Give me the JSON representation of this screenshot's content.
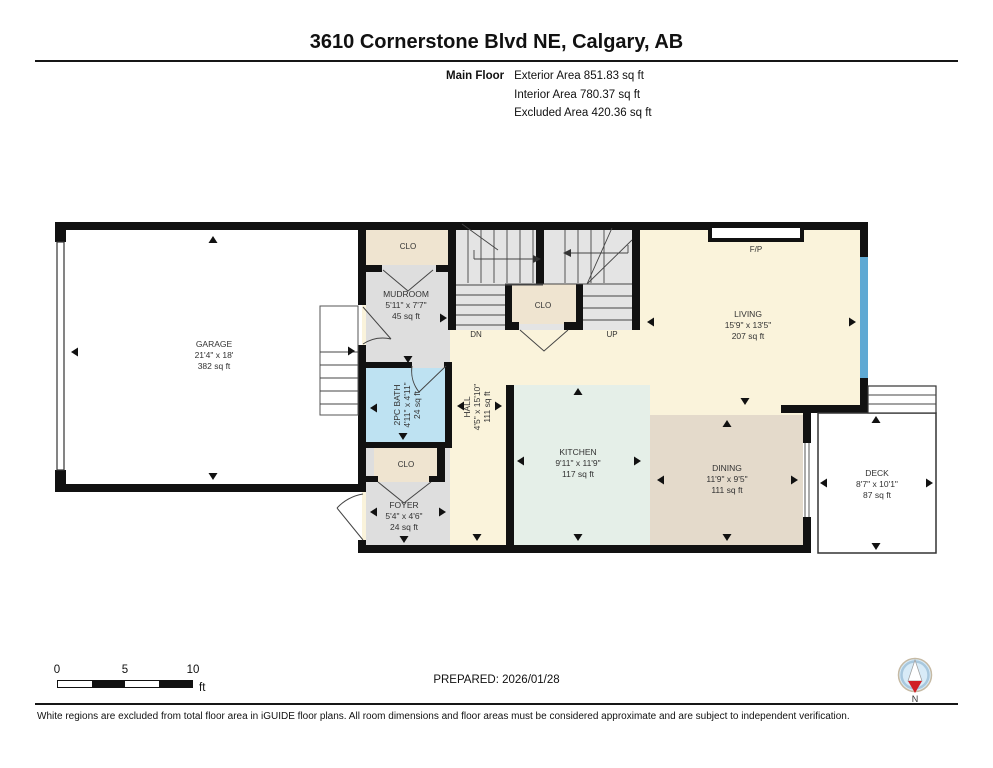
{
  "header": {
    "title": "3610 Cornerstone Blvd NE, Calgary, AB",
    "floor_label": "Main Floor",
    "areas": [
      "Exterior Area 851.83 sq ft",
      "Interior Area 780.37 sq ft",
      "Excluded Area 420.36 sq ft"
    ]
  },
  "rooms": {
    "garage": {
      "label": "GARAGE",
      "dims": "21'4\" x 18'",
      "area": "382 sq ft"
    },
    "mudroom": {
      "label": "MUDROOM",
      "dims": "5'11\" x 7'7\"",
      "area": "45 sq ft"
    },
    "bath": {
      "label": "2PC BATH",
      "dims": "4'11\" x 4'11\"",
      "area": "24 sq ft"
    },
    "hall": {
      "label": "HALL",
      "dims": "4'5\" x 15'10\"",
      "area": "111 sq ft"
    },
    "foyer": {
      "label": "FOYER",
      "dims": "5'4\" x 4'6\"",
      "area": "24 sq ft"
    },
    "kitchen": {
      "label": "KITCHEN",
      "dims": "9'11\" x 11'9\"",
      "area": "117 sq ft"
    },
    "dining": {
      "label": "DINING",
      "dims": "11'9\" x 9'5\"",
      "area": "111 sq ft"
    },
    "living": {
      "label": "LIVING",
      "dims": "15'9\" x 13'5\"",
      "area": "207 sq ft"
    },
    "deck": {
      "label": "DECK",
      "dims": "8'7\" x 10'1\"",
      "area": "87 sq ft"
    }
  },
  "plan_labels": {
    "closet": "CLO",
    "fireplace": "F/P",
    "stairs_down": "DN",
    "stairs_up": "UP"
  },
  "footer": {
    "prepared": "PREPARED: 2026/01/28",
    "scale_ticks": [
      "0",
      "5",
      "10"
    ],
    "scale_unit": "ft",
    "compass_label": "N",
    "disclaimer": "White regions are excluded from total floor area in iGUIDE floor plans. All room dimensions and floor areas must be considered approximate and are subject to independent verification."
  },
  "colors": {
    "wall": "#111111",
    "floor_cream": "#FAF3DB",
    "floor_gray": "#DEDEDE",
    "floor_stairs": "#E4E4E4",
    "floor_kitchen": "#E5EFE8",
    "floor_dining": "#E4DACB",
    "floor_bath": "#BEE2F2",
    "floor_closet": "#EFE4D0",
    "window_blue": "#5FA9D3",
    "compass_fill": "#D8EBF7",
    "compass_red": "#D01F26"
  }
}
